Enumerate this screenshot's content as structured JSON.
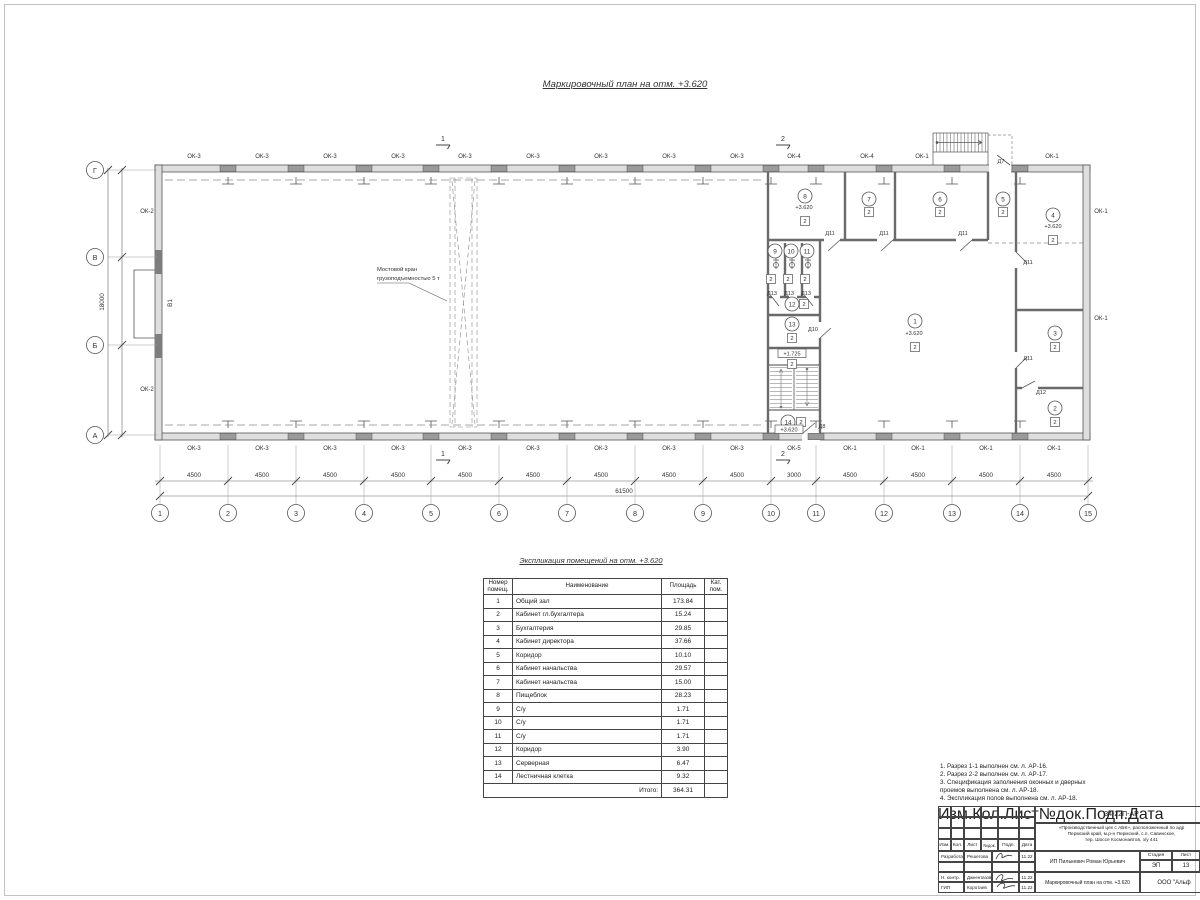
{
  "page": {
    "plan_title": "Маркировочный план  на отм. +3.620",
    "expl_title": "Экспликация помещений на отм. +3.620"
  },
  "plan": {
    "crane_note_line1": "Мостовой кран",
    "crane_note_line2": "грузоподъемностью 5 т",
    "gate_label": "В1",
    "dim_total_bottom": "61500",
    "dim_total_left": "18000",
    "axes_bottom": [
      {
        "label": "1",
        "x": 160
      },
      {
        "label": "2",
        "x": 228
      },
      {
        "label": "3",
        "x": 296
      },
      {
        "label": "4",
        "x": 364
      },
      {
        "label": "5",
        "x": 431
      },
      {
        "label": "6",
        "x": 499
      },
      {
        "label": "7",
        "x": 567
      },
      {
        "label": "8",
        "x": 635
      },
      {
        "label": "9",
        "x": 703
      },
      {
        "label": "10",
        "x": 771
      },
      {
        "label": "11",
        "x": 816
      },
      {
        "label": "12",
        "x": 884
      },
      {
        "label": "13",
        "x": 952
      },
      {
        "label": "14",
        "x": 1020
      },
      {
        "label": "15",
        "x": 1088
      }
    ],
    "axes_left": [
      {
        "label": "Г",
        "y": 170
      },
      {
        "label": "В",
        "y": 257
      },
      {
        "label": "Б",
        "y": 345
      },
      {
        "label": "А",
        "y": 435
      }
    ],
    "dims_bottom": [
      {
        "label": "4500",
        "x": 194
      },
      {
        "label": "4500",
        "x": 262
      },
      {
        "label": "4500",
        "x": 330
      },
      {
        "label": "4500",
        "x": 398
      },
      {
        "label": "4500",
        "x": 465
      },
      {
        "label": "4500",
        "x": 533
      },
      {
        "label": "4500",
        "x": 601
      },
      {
        "label": "4500",
        "x": 669
      },
      {
        "label": "4500",
        "x": 737
      },
      {
        "label": "3000",
        "x": 794
      },
      {
        "label": "4500",
        "x": 850
      },
      {
        "label": "4500",
        "x": 918
      },
      {
        "label": "4500",
        "x": 986
      },
      {
        "label": "4500",
        "x": 1054
      }
    ],
    "dims_left": [
      {
        "label": "6000",
        "y": 213
      },
      {
        "label": "6000",
        "y": 301
      },
      {
        "label": "6000",
        "y": 390
      }
    ],
    "windows_top": [
      {
        "label": "ОК-3",
        "x": 194
      },
      {
        "label": "ОК-3",
        "x": 262
      },
      {
        "label": "ОК-3",
        "x": 330
      },
      {
        "label": "ОК-3",
        "x": 398
      },
      {
        "label": "ОК-3",
        "x": 465
      },
      {
        "label": "ОК-3",
        "x": 533
      },
      {
        "label": "ОК-3",
        "x": 601
      },
      {
        "label": "ОК-3",
        "x": 669
      },
      {
        "label": "ОК-3",
        "x": 737
      },
      {
        "label": "ОК-4",
        "x": 794
      },
      {
        "label": "ОК-4",
        "x": 867
      },
      {
        "label": "ОК-1",
        "x": 922
      },
      {
        "label": "ОК-1",
        "x": 1052
      }
    ],
    "windows_bottom": [
      {
        "label": "ОК-3",
        "x": 194
      },
      {
        "label": "ОК-3",
        "x": 262
      },
      {
        "label": "ОК-3",
        "x": 330
      },
      {
        "label": "ОК-3",
        "x": 398
      },
      {
        "label": "ОК-3",
        "x": 465
      },
      {
        "label": "ОК-3",
        "x": 533
      },
      {
        "label": "ОК-3",
        "x": 601
      },
      {
        "label": "ОК-3",
        "x": 669
      },
      {
        "label": "ОК-3",
        "x": 737
      },
      {
        "label": "ОК-5",
        "x": 794
      },
      {
        "label": "ОК-1",
        "x": 850
      },
      {
        "label": "ОК-1",
        "x": 918
      },
      {
        "label": "ОК-1",
        "x": 986
      },
      {
        "label": "ОК-1",
        "x": 1054
      }
    ],
    "windows_side": [
      {
        "label": "ОК-2",
        "x": 147,
        "y": 213
      },
      {
        "label": "ОК-2",
        "x": 147,
        "y": 391
      },
      {
        "label": "ОК-1",
        "x": 1101,
        "y": 213
      },
      {
        "label": "ОК-1",
        "x": 1101,
        "y": 320
      }
    ],
    "rooms": [
      {
        "label": "1",
        "x": 915,
        "y": 321
      },
      {
        "label": "2",
        "x": 1055,
        "y": 408
      },
      {
        "label": "3",
        "x": 1055,
        "y": 333
      },
      {
        "label": "4",
        "x": 1053,
        "y": 215
      },
      {
        "label": "5",
        "x": 1003,
        "y": 199
      },
      {
        "label": "6",
        "x": 940,
        "y": 199
      },
      {
        "label": "7",
        "x": 869,
        "y": 199
      },
      {
        "label": "8",
        "x": 805,
        "y": 196
      },
      {
        "label": "9",
        "x": 775,
        "y": 251
      },
      {
        "label": "10",
        "x": 791,
        "y": 251
      },
      {
        "label": "11",
        "x": 807,
        "y": 251
      },
      {
        "label": "12",
        "x": 792,
        "y": 304
      },
      {
        "label": "13",
        "x": 792,
        "y": 324
      },
      {
        "label": "14",
        "x": 788,
        "y": 422
      }
    ],
    "categories": [
      {
        "label": "2",
        "x": 915,
        "y": 347
      },
      {
        "label": "2",
        "x": 1055,
        "y": 422
      },
      {
        "label": "2",
        "x": 1055,
        "y": 347
      },
      {
        "label": "2",
        "x": 1053,
        "y": 240
      },
      {
        "label": "2",
        "x": 1003,
        "y": 212
      },
      {
        "label": "2",
        "x": 940,
        "y": 212
      },
      {
        "label": "2",
        "x": 869,
        "y": 212
      },
      {
        "label": "2",
        "x": 805,
        "y": 221
      },
      {
        "label": "2",
        "x": 771,
        "y": 279
      },
      {
        "label": "2",
        "x": 788,
        "y": 279
      },
      {
        "label": "2",
        "x": 805,
        "y": 279
      },
      {
        "label": "2",
        "x": 804,
        "y": 304
      },
      {
        "label": "2",
        "x": 792,
        "y": 338
      },
      {
        "label": "2",
        "x": 792,
        "y": 364
      },
      {
        "label": "2",
        "x": 801,
        "y": 422
      }
    ],
    "elevations": [
      {
        "label": "+3.620",
        "x": 804,
        "y": 209
      },
      {
        "label": "+3.620",
        "x": 1053,
        "y": 228
      },
      {
        "label": "+3.620",
        "x": 914,
        "y": 335
      }
    ],
    "boxed_elevations": [
      {
        "label": "+1.725",
        "x": 792,
        "y": 355
      },
      {
        "label": "+3.620",
        "x": 789,
        "y": 431
      }
    ],
    "doors": [
      {
        "label": "Д11",
        "x": 830,
        "y": 235
      },
      {
        "label": "Д11",
        "x": 884,
        "y": 235
      },
      {
        "label": "Д11",
        "x": 963,
        "y": 235
      },
      {
        "label": "Д11",
        "x": 1028,
        "y": 264
      },
      {
        "label": "Д11",
        "x": 1028,
        "y": 360
      },
      {
        "label": "Д12",
        "x": 1041,
        "y": 394
      },
      {
        "label": "Д13",
        "x": 772,
        "y": 295
      },
      {
        "label": "Д13",
        "x": 789,
        "y": 295
      },
      {
        "label": "Д13",
        "x": 806,
        "y": 295
      },
      {
        "label": "Д10",
        "x": 813,
        "y": 331
      },
      {
        "label": "Д8",
        "x": 822,
        "y": 428
      },
      {
        "label": "Д7",
        "x": 1001,
        "y": 163
      }
    ],
    "sections": [
      {
        "label": "1",
        "x": 443,
        "y": 141
      },
      {
        "label": "1",
        "x": 443,
        "y": 456
      },
      {
        "label": "2",
        "x": 783,
        "y": 141
      },
      {
        "label": "2",
        "x": 783,
        "y": 456
      }
    ],
    "wall_piers": [
      {
        "x": 228
      },
      {
        "x": 296
      },
      {
        "x": 364
      },
      {
        "x": 431
      },
      {
        "x": 499
      },
      {
        "x": 567
      },
      {
        "x": 635
      },
      {
        "x": 703
      },
      {
        "x": 771
      },
      {
        "x": 816
      },
      {
        "x": 884
      },
      {
        "x": 952
      },
      {
        "x": 1020
      }
    ]
  },
  "table": {
    "headers": {
      "num": "Номер помещ.",
      "name": "Наименование",
      "area": "Площадь",
      "cat": "Кат. пом."
    },
    "rows": [
      {
        "n": "1",
        "name": "Общий зал",
        "area": "173.84",
        "cat": ""
      },
      {
        "n": "2",
        "name": "Кабинет гл.бухгалтера",
        "area": "15.24",
        "cat": ""
      },
      {
        "n": "3",
        "name": "Бухгалтерия",
        "area": "29.85",
        "cat": ""
      },
      {
        "n": "4",
        "name": "Кабинет директора",
        "area": "37.66",
        "cat": ""
      },
      {
        "n": "5",
        "name": "Коридор",
        "area": "10.10",
        "cat": ""
      },
      {
        "n": "6",
        "name": "Кабинет начальства",
        "area": "29.57",
        "cat": ""
      },
      {
        "n": "7",
        "name": "Кабинет начальства",
        "area": "15.00",
        "cat": ""
      },
      {
        "n": "8",
        "name": "Пищеблок",
        "area": "28.23",
        "cat": ""
      },
      {
        "n": "9",
        "name": "С/у",
        "area": "1.71",
        "cat": ""
      },
      {
        "n": "10",
        "name": "С/у",
        "area": "1.71",
        "cat": ""
      },
      {
        "n": "11",
        "name": "С/у",
        "area": "1.71",
        "cat": ""
      },
      {
        "n": "12",
        "name": "Коридор",
        "area": "3.90",
        "cat": ""
      },
      {
        "n": "13",
        "name": "Серверная",
        "area": "6.47",
        "cat": ""
      },
      {
        "n": "14",
        "name": "Лестничная клетка",
        "area": "9.32",
        "cat": ""
      }
    ],
    "total_label": "Итого:",
    "total": "364.31"
  },
  "notes": {
    "items": [
      {
        "text": "1. Разрез 1-1 выполнен см. л. АР-16."
      },
      {
        "text": "2. Разрез 2-2 выполнен см. л. АР-17."
      },
      {
        "text": "3. Спецификация заполнения оконных и дверных\n    проемов выполнена см. л. АР-18."
      },
      {
        "text": "4. Экспликация полов выполнена см. л. АР-18."
      }
    ]
  },
  "titleblock": {
    "doc_number": "34-22П-АР",
    "project_line1": "«Производственный цех с АБК», расположенный по адр",
    "project_line2": "Пермский край, м.р-н Пермский, с.п. Савинское,",
    "project_line3": "тер. Шоссе Космонавтов, з/у 441",
    "rev_headers": [
      {
        "label": "Изм."
      },
      {
        "label": "Кол."
      },
      {
        "label": "Лист"
      },
      {
        "label": "№док."
      },
      {
        "label": "Подп."
      },
      {
        "label": "Дата"
      }
    ],
    "row1_role": "Разработал",
    "row1_name": "Решетова",
    "row1_date": "11.22",
    "row3_role": "Н. контр.",
    "row3_name": "Джеентазов",
    "row3_date": "11.22",
    "row4_role": "ГИП",
    "row4_name": "Коротаев",
    "row4_date": "11.22",
    "client": "ИП Пилькевич Роман Юрьевич",
    "stage_label": "Стадия",
    "sheet_label": "Лист",
    "stage": "ЭП",
    "sheet": "13",
    "sheet_title": "Маркировочный план на отм. +3.620",
    "company": "ООО \"Альф"
  }
}
